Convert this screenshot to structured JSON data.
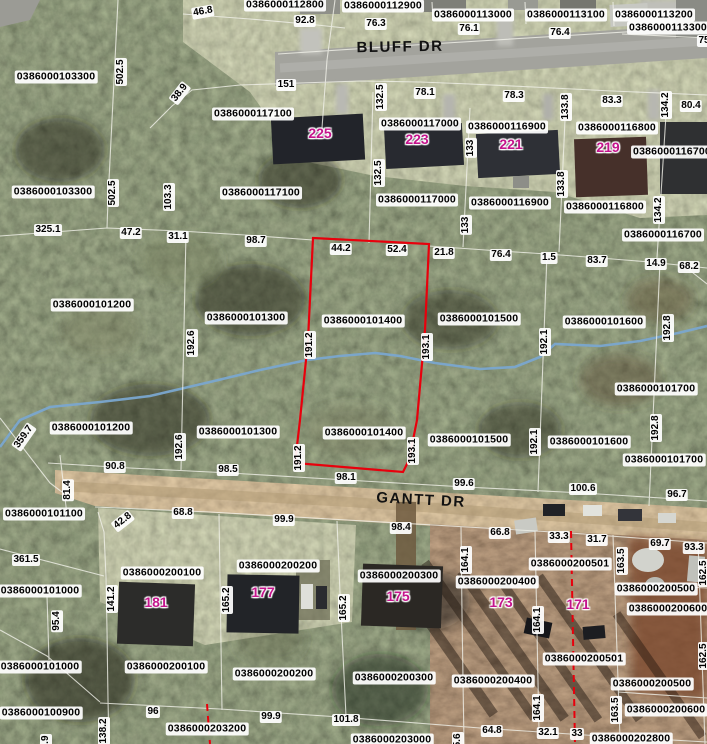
{
  "map": {
    "type": "gis-parcel-aerial-view",
    "highlighted_parcel_id": "0386000101400",
    "colors": {
      "selected_parcel_outline": "#e8000c",
      "zoning_dashed_line": "#e8000c",
      "parcel_line": "#f2f2ea",
      "stream": "#7aa6cf",
      "house_number_text": "#c4148c",
      "label_background": "#ffffff"
    },
    "streets": [
      {
        "text": "BLUFF DR",
        "x": 400,
        "y": 47,
        "rot": -1
      },
      {
        "text": "GANTT DR",
        "x": 421,
        "y": 500,
        "rot": 3
      }
    ],
    "parcel_labels": [
      {
        "text": "0386000112800",
        "x": 285,
        "y": 5
      },
      {
        "text": "0386000112900",
        "x": 383,
        "y": 6
      },
      {
        "text": "0386000113000",
        "x": 473,
        "y": 15
      },
      {
        "text": "0386000113100",
        "x": 566,
        "y": 15
      },
      {
        "text": "0386000113200",
        "x": 654,
        "y": 15
      },
      {
        "text": "0386000113300",
        "x": 668,
        "y": 28
      },
      {
        "text": "0386000103300",
        "x": 56,
        "y": 77
      },
      {
        "text": "0386000117100",
        "x": 253,
        "y": 114
      },
      {
        "text": "0386000117000",
        "x": 420,
        "y": 124
      },
      {
        "text": "0386000116900",
        "x": 507,
        "y": 127
      },
      {
        "text": "0386000116800",
        "x": 617,
        "y": 128
      },
      {
        "text": "0386000116700",
        "x": 672,
        "y": 152
      },
      {
        "text": "0386000103300",
        "x": 53,
        "y": 192
      },
      {
        "text": "0386000117100",
        "x": 261,
        "y": 193
      },
      {
        "text": "0386000117000",
        "x": 417,
        "y": 200
      },
      {
        "text": "0386000116900",
        "x": 510,
        "y": 203
      },
      {
        "text": "0386000116800",
        "x": 605,
        "y": 207
      },
      {
        "text": "0386000116700",
        "x": 663,
        "y": 235
      },
      {
        "text": "0386000101200",
        "x": 92,
        "y": 305
      },
      {
        "text": "0386000101300",
        "x": 246,
        "y": 318
      },
      {
        "text": "0386000101400",
        "x": 363,
        "y": 321
      },
      {
        "text": "0386000101500",
        "x": 479,
        "y": 319
      },
      {
        "text": "0386000101600",
        "x": 604,
        "y": 322
      },
      {
        "text": "0386000101700",
        "x": 656,
        "y": 389
      },
      {
        "text": "0386000101200",
        "x": 91,
        "y": 428
      },
      {
        "text": "0386000101300",
        "x": 238,
        "y": 432
      },
      {
        "text": "0386000101400",
        "x": 364,
        "y": 433
      },
      {
        "text": "0386000101500",
        "x": 469,
        "y": 440
      },
      {
        "text": "0386000101600",
        "x": 589,
        "y": 442
      },
      {
        "text": "0386000101700",
        "x": 664,
        "y": 460
      },
      {
        "text": "0386000101100",
        "x": 44,
        "y": 514
      },
      {
        "text": "0386000200100",
        "x": 162,
        "y": 573
      },
      {
        "text": "0386000200200",
        "x": 278,
        "y": 566
      },
      {
        "text": "0386000101000",
        "x": 40,
        "y": 591
      },
      {
        "text": "0386000200300",
        "x": 399,
        "y": 576
      },
      {
        "text": "0386000200400",
        "x": 497,
        "y": 582
      },
      {
        "text": "0386000200501",
        "x": 570,
        "y": 564
      },
      {
        "text": "0386000200500",
        "x": 656,
        "y": 589
      },
      {
        "text": "0386000200600",
        "x": 668,
        "y": 609
      },
      {
        "text": "0386000200100",
        "x": 166,
        "y": 667
      },
      {
        "text": "0386000200200",
        "x": 274,
        "y": 674
      },
      {
        "text": "0386000200300",
        "x": 394,
        "y": 678
      },
      {
        "text": "0386000200400",
        "x": 493,
        "y": 681
      },
      {
        "text": "0386000200501",
        "x": 584,
        "y": 659
      },
      {
        "text": "0386000200500",
        "x": 652,
        "y": 684
      },
      {
        "text": "0386000200600",
        "x": 666,
        "y": 710
      },
      {
        "text": "0386000101000",
        "x": 40,
        "y": 667
      },
      {
        "text": "0386000100900",
        "x": 41,
        "y": 713
      },
      {
        "text": "0386000203200",
        "x": 207,
        "y": 729
      },
      {
        "text": "0386000203000",
        "x": 392,
        "y": 740
      },
      {
        "text": "0386000202800",
        "x": 631,
        "y": 739
      }
    ],
    "dimension_labels": [
      {
        "text": "46.8",
        "x": 203,
        "y": 12,
        "rot": -10
      },
      {
        "text": "92.8",
        "x": 305,
        "y": 21
      },
      {
        "text": "76.3",
        "x": 376,
        "y": 24
      },
      {
        "text": "76.1",
        "x": 469,
        "y": 29
      },
      {
        "text": "76.4",
        "x": 560,
        "y": 33
      },
      {
        "text": "75",
        "x": 704,
        "y": 41
      },
      {
        "text": "502.5",
        "x": 121,
        "y": 72,
        "rot": -90
      },
      {
        "text": "38.9",
        "x": 180,
        "y": 93,
        "rot": -52
      },
      {
        "text": "151",
        "x": 286,
        "y": 85
      },
      {
        "text": "78.1",
        "x": 425,
        "y": 93
      },
      {
        "text": "132.5",
        "x": 381,
        "y": 97,
        "rot": -90
      },
      {
        "text": "78.3",
        "x": 514,
        "y": 96
      },
      {
        "text": "133.8",
        "x": 566,
        "y": 107,
        "rot": -90
      },
      {
        "text": "83.3",
        "x": 612,
        "y": 101
      },
      {
        "text": "134.2",
        "x": 666,
        "y": 105,
        "rot": -90
      },
      {
        "text": "80.4",
        "x": 691,
        "y": 106
      },
      {
        "text": "502.5",
        "x": 113,
        "y": 193,
        "rot": -90
      },
      {
        "text": "103.3",
        "x": 169,
        "y": 197,
        "rot": -90
      },
      {
        "text": "132.5",
        "x": 379,
        "y": 173,
        "rot": -90
      },
      {
        "text": "133",
        "x": 471,
        "y": 148,
        "rot": -90
      },
      {
        "text": "133",
        "x": 466,
        "y": 225,
        "rot": -90
      },
      {
        "text": "133.8",
        "x": 562,
        "y": 184,
        "rot": -90
      },
      {
        "text": "134.2",
        "x": 659,
        "y": 210,
        "rot": -90
      },
      {
        "text": "325.1",
        "x": 48,
        "y": 230
      },
      {
        "text": "47.2",
        "x": 131,
        "y": 233
      },
      {
        "text": "31.1",
        "x": 178,
        "y": 237
      },
      {
        "text": "98.7",
        "x": 256,
        "y": 241
      },
      {
        "text": "44.2",
        "x": 341,
        "y": 249
      },
      {
        "text": "52.4",
        "x": 397,
        "y": 250
      },
      {
        "text": "21.8",
        "x": 444,
        "y": 253
      },
      {
        "text": "76.4",
        "x": 501,
        "y": 255
      },
      {
        "text": "1.5",
        "x": 549,
        "y": 258
      },
      {
        "text": "83.7",
        "x": 597,
        "y": 261
      },
      {
        "text": "14.9",
        "x": 656,
        "y": 264
      },
      {
        "text": "68.2",
        "x": 689,
        "y": 267
      },
      {
        "text": "192.6",
        "x": 192,
        "y": 343,
        "rot": -90
      },
      {
        "text": "191.2",
        "x": 310,
        "y": 345,
        "rot": -90
      },
      {
        "text": "193.1",
        "x": 427,
        "y": 347,
        "rot": -90
      },
      {
        "text": "192.1",
        "x": 545,
        "y": 342,
        "rot": -90
      },
      {
        "text": "192.8",
        "x": 668,
        "y": 328,
        "rot": -90
      },
      {
        "text": "359.7",
        "x": 24,
        "y": 437,
        "rot": -55
      },
      {
        "text": "192.6",
        "x": 180,
        "y": 447,
        "rot": -90
      },
      {
        "text": "191.2",
        "x": 299,
        "y": 458,
        "rot": -90
      },
      {
        "text": "193.1",
        "x": 413,
        "y": 451,
        "rot": -90
      },
      {
        "text": "192.1",
        "x": 535,
        "y": 442,
        "rot": -90
      },
      {
        "text": "192.8",
        "x": 656,
        "y": 428,
        "rot": -90
      },
      {
        "text": "81.4",
        "x": 68,
        "y": 490,
        "rot": -90
      },
      {
        "text": "90.8",
        "x": 115,
        "y": 467
      },
      {
        "text": "98.5",
        "x": 228,
        "y": 470
      },
      {
        "text": "98.1",
        "x": 346,
        "y": 478
      },
      {
        "text": "99.6",
        "x": 464,
        "y": 484
      },
      {
        "text": "100.6",
        "x": 583,
        "y": 489
      },
      {
        "text": "96.7",
        "x": 677,
        "y": 495
      },
      {
        "text": "42.8",
        "x": 123,
        "y": 521,
        "rot": -38
      },
      {
        "text": "68.8",
        "x": 183,
        "y": 513
      },
      {
        "text": "99.9",
        "x": 284,
        "y": 520
      },
      {
        "text": "361.5",
        "x": 26,
        "y": 560
      },
      {
        "text": "141.2",
        "x": 112,
        "y": 599,
        "rot": -90
      },
      {
        "text": "165.2",
        "x": 227,
        "y": 600,
        "rot": -90
      },
      {
        "text": "165.2",
        "x": 344,
        "y": 608,
        "rot": -90
      },
      {
        "text": "95.4",
        "x": 57,
        "y": 621,
        "rot": -90
      },
      {
        "text": "98.4",
        "x": 401,
        "y": 528
      },
      {
        "text": "66.8",
        "x": 500,
        "y": 533
      },
      {
        "text": "33.3",
        "x": 559,
        "y": 537
      },
      {
        "text": "31.7",
        "x": 597,
        "y": 540
      },
      {
        "text": "69.7",
        "x": 660,
        "y": 544
      },
      {
        "text": "93.3",
        "x": 694,
        "y": 548
      },
      {
        "text": "164.1",
        "x": 466,
        "y": 560,
        "rot": -90
      },
      {
        "text": "163.5",
        "x": 622,
        "y": 561,
        "rot": -90
      },
      {
        "text": "162.5",
        "x": 704,
        "y": 573,
        "rot": -90
      },
      {
        "text": "164.1",
        "x": 538,
        "y": 620,
        "rot": -90
      },
      {
        "text": "164.1",
        "x": 538,
        "y": 708,
        "rot": -90
      },
      {
        "text": "163.5",
        "x": 616,
        "y": 710,
        "rot": -90
      },
      {
        "text": "162.5",
        "x": 704,
        "y": 656,
        "rot": -90
      },
      {
        "text": "138.2",
        "x": 104,
        "y": 731,
        "rot": -90
      },
      {
        "text": "137.9",
        "x": 46,
        "y": 748,
        "rot": -90
      },
      {
        "text": "96",
        "x": 153,
        "y": 712
      },
      {
        "text": "99.9",
        "x": 271,
        "y": 717
      },
      {
        "text": "101.8",
        "x": 346,
        "y": 720
      },
      {
        "text": "165.6",
        "x": 458,
        "y": 746,
        "rot": -90
      },
      {
        "text": "64.8",
        "x": 492,
        "y": 731
      },
      {
        "text": "32.1",
        "x": 548,
        "y": 733
      },
      {
        "text": "33",
        "x": 577,
        "y": 734
      }
    ],
    "house_numbers": [
      {
        "text": "225",
        "x": 320,
        "y": 133
      },
      {
        "text": "223",
        "x": 417,
        "y": 139
      },
      {
        "text": "221",
        "x": 511,
        "y": 144
      },
      {
        "text": "219",
        "x": 608,
        "y": 147
      },
      {
        "text": "181",
        "x": 156,
        "y": 602
      },
      {
        "text": "177",
        "x": 263,
        "y": 592
      },
      {
        "text": "175",
        "x": 398,
        "y": 596
      },
      {
        "text": "173",
        "x": 501,
        "y": 602
      },
      {
        "text": "171",
        "x": 578,
        "y": 604
      }
    ]
  }
}
